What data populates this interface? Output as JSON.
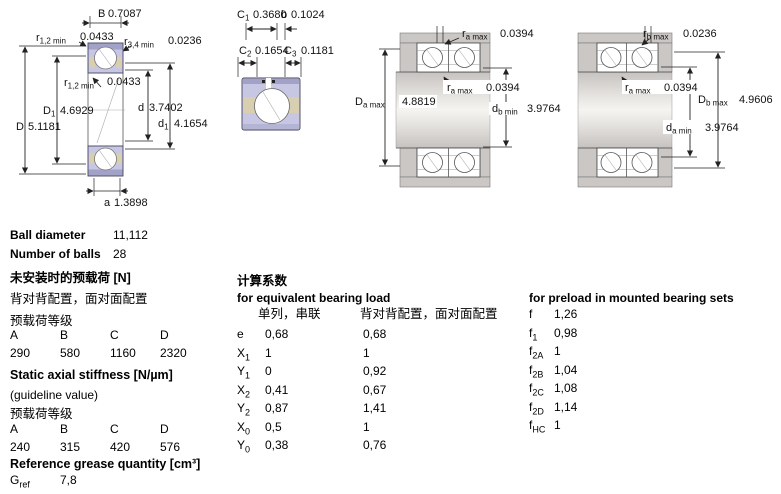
{
  "d1": {
    "B": {
      "b": "B",
      "s": "",
      "v": "0.7087"
    },
    "r12top": {
      "b": "r",
      "s": "1,2 min",
      "v": "0.0433"
    },
    "r34": {
      "b": "r",
      "s": "3,4 min",
      "v": "0.0236"
    },
    "r12in": {
      "b": "r",
      "s": "1,2 min",
      "v": "0.0433"
    },
    "D1": {
      "b": "D",
      "s": "1",
      "v": "4.6929"
    },
    "D": {
      "b": "D",
      "s": "",
      "v": "5.1181"
    },
    "d": {
      "b": "d",
      "s": "",
      "v": "3.7402"
    },
    "d1": {
      "b": "d",
      "s": "1",
      "v": "4.1654"
    },
    "a": {
      "b": "a",
      "s": "",
      "v": "1.3898"
    }
  },
  "d2": {
    "C1": {
      "b": "C",
      "s": "1",
      "v": "0.3680"
    },
    "b": {
      "b": "b",
      "s": "",
      "v": "0.1024"
    },
    "C2": {
      "b": "C",
      "s": "2",
      "v": "0.1654"
    },
    "C3": {
      "b": "C",
      "s": "3",
      "v": "0.1181"
    }
  },
  "d3": {
    "ra_top": {
      "b": "r",
      "s": "a max",
      "v": "0.0394"
    },
    "ra_in": {
      "b": "r",
      "s": "a max",
      "v": "0.0394"
    },
    "Da": {
      "b": "D",
      "s": "a max",
      "v": "4.8819"
    },
    "db": {
      "b": "d",
      "s": "b min",
      "v": "3.9764"
    }
  },
  "d4": {
    "rb_top": {
      "b": "r",
      "s": "b max",
      "v": "0.0236"
    },
    "ra_in": {
      "b": "r",
      "s": "a max",
      "v": "0.0394"
    },
    "Db": {
      "b": "D",
      "s": "b max",
      "v": "4.9606"
    },
    "da": {
      "b": "d",
      "s": "a min",
      "v": "3.9764"
    }
  },
  "specs": {
    "ball_diameter": {
      "label": "Ball diameter",
      "value": "11,112"
    },
    "number_of_balls": {
      "label": "Number of balls",
      "value": "28"
    }
  },
  "preload": {
    "title": "未安装时的预载荷 [N]",
    "subtitle": "背对背配置，面对面配置",
    "class_label": "预载荷等级",
    "headers": [
      "A",
      "B",
      "C",
      "D"
    ],
    "values": [
      "290",
      "580",
      "1160",
      "2320"
    ]
  },
  "stiffness": {
    "title": "Static axial stiffness [N/µm]",
    "subtitle": "(guideline value)",
    "class_label": "预载荷等级",
    "headers": [
      "A",
      "B",
      "C",
      "D"
    ],
    "values": [
      "240",
      "315",
      "420",
      "576"
    ]
  },
  "grease": {
    "title": "Reference grease quantity [cm³]",
    "row": {
      "b": "G",
      "s": "ref",
      "v": "7,8"
    }
  },
  "calc": {
    "title_cn": "计算系数",
    "equiv_title": "for equivalent bearing load",
    "col1_header": "单列，串联",
    "col2_header": "背对背配置，面对面配置",
    "rows": [
      {
        "b": "e",
        "s": "",
        "v1": "0,68",
        "v2": "0,68"
      },
      {
        "b": "X",
        "s": "1",
        "v1": "1",
        "v2": "1"
      },
      {
        "b": "Y",
        "s": "1",
        "v1": "0",
        "v2": "0,92"
      },
      {
        "b": "X",
        "s": "2",
        "v1": "0,41",
        "v2": "0,67"
      },
      {
        "b": "Y",
        "s": "2",
        "v1": "0,87",
        "v2": "1,41"
      },
      {
        "b": "X",
        "s": "0",
        "v1": "0,5",
        "v2": "1"
      },
      {
        "b": "Y",
        "s": "0",
        "v1": "0,38",
        "v2": "0,76"
      }
    ],
    "preload_title": "for preload in mounted bearing sets",
    "preload_rows": [
      {
        "b": "f",
        "s": "",
        "v": "1,26"
      },
      {
        "b": "f",
        "s": "1",
        "v": "0,98"
      },
      {
        "b": "f",
        "s": "2A",
        "v": "1"
      },
      {
        "b": "f",
        "s": "2B",
        "v": "1,04"
      },
      {
        "b": "f",
        "s": "2C",
        "v": "1,08"
      },
      {
        "b": "f",
        "s": "2D",
        "v": "1,14"
      },
      {
        "b": "f",
        "s": "HC",
        "v": "1"
      }
    ]
  }
}
